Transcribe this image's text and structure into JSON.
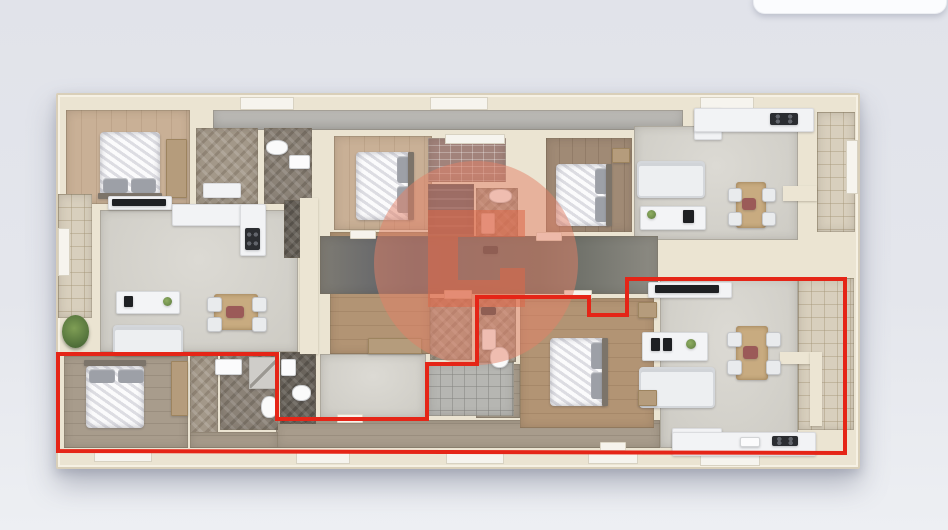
{
  "scene": {
    "canvas": {
      "w": 948,
      "h": 530
    },
    "colors": {
      "background_top": "#e1e3ea",
      "background_bottom": "#edeff3",
      "wall": "#ebe4d2",
      "highlight_red": "#e52517",
      "watermark_circle": "#e48066",
      "watermark_glyph": "#dc6748"
    },
    "overlay_card": {
      "x": 753,
      "y": -12,
      "w": 192,
      "h": 24,
      "radius": 12
    },
    "building": {
      "x": 56,
      "y": 93,
      "w": 800,
      "h": 372
    },
    "rooms": [
      {
        "n": "top-terrace-strip",
        "c": "strip",
        "x": 213,
        "y": 110,
        "w": 470,
        "h": 20
      },
      {
        "n": "bedroom-top-left-floor",
        "c": "wood-light",
        "x": 66,
        "y": 110,
        "w": 124,
        "h": 94
      },
      {
        "n": "closet-top-left-floor",
        "c": "herr-light",
        "x": 196,
        "y": 128,
        "w": 62,
        "h": 76
      },
      {
        "n": "bathroom-top-left-floor",
        "c": "herr-gray",
        "x": 264,
        "y": 128,
        "w": 48,
        "h": 76
      },
      {
        "n": "living-top-left-floor",
        "c": "living",
        "x": 100,
        "y": 210,
        "w": 198,
        "h": 142
      },
      {
        "n": "hall-top-left-floor",
        "c": "herr-dark",
        "x": 284,
        "y": 200,
        "w": 32,
        "h": 58
      },
      {
        "n": "terrace-left-floor",
        "c": "tile-beige",
        "x": 58,
        "y": 194,
        "w": 34,
        "h": 124
      },
      {
        "n": "bedroom-mid-left-floor",
        "c": "wood-med",
        "x": 330,
        "y": 232,
        "w": 100,
        "h": 122
      },
      {
        "n": "bedroom-top-center-floor",
        "c": "wood-light",
        "x": 334,
        "y": 136,
        "w": 98,
        "h": 94
      },
      {
        "n": "brick-patio-floor",
        "c": "brick",
        "x": 428,
        "y": 138,
        "w": 78,
        "h": 44
      },
      {
        "n": "stairwell-floor",
        "c": "stairs",
        "x": 428,
        "y": 184,
        "w": 46,
        "h": 52
      },
      {
        "n": "bathroom-top-center-floor",
        "c": "herr-light",
        "x": 476,
        "y": 188,
        "w": 42,
        "h": 76
      },
      {
        "n": "bedroom-top-right-floor",
        "c": "wood-dark",
        "x": 546,
        "y": 138,
        "w": 86,
        "h": 94
      },
      {
        "n": "living-top-right-floor",
        "c": "living",
        "x": 634,
        "y": 126,
        "w": 164,
        "h": 114
      },
      {
        "n": "terrace-top-right-floor",
        "c": "tile-beige",
        "x": 817,
        "y": 112,
        "w": 38,
        "h": 120
      },
      {
        "n": "corridor-center-floor",
        "c": "corridor",
        "x": 320,
        "y": 236,
        "w": 338,
        "h": 58
      },
      {
        "n": "hall-mid-left-floor",
        "c": "living",
        "x": 320,
        "y": 354,
        "w": 106,
        "h": 64
      },
      {
        "n": "bathroom-notch-floor",
        "c": "herr-light",
        "x": 430,
        "y": 298,
        "w": 42,
        "h": 62
      },
      {
        "n": "bathroom-bottom-center-floor",
        "c": "herr-light",
        "x": 476,
        "y": 298,
        "w": 40,
        "h": 64
      },
      {
        "n": "hall-bottom-center-floor",
        "c": "wood-gray",
        "x": 476,
        "y": 364,
        "w": 44,
        "h": 54
      },
      {
        "n": "corridor-bottom-floor",
        "c": "wood-gray",
        "x": 276,
        "y": 420,
        "w": 384,
        "h": 28
      },
      {
        "n": "tile-patio-bottom-floor",
        "c": "tile-gray",
        "x": 428,
        "y": 362,
        "w": 86,
        "h": 54
      },
      {
        "n": "bedroom-bottom-center-floor",
        "c": "wood-med",
        "x": 520,
        "y": 298,
        "w": 134,
        "h": 130
      },
      {
        "n": "living-bottom-right-floor",
        "c": "living",
        "x": 660,
        "y": 278,
        "w": 138,
        "h": 170
      },
      {
        "n": "terrace-bottom-right-floor",
        "c": "tile-beige",
        "x": 798,
        "y": 278,
        "w": 56,
        "h": 152
      },
      {
        "n": "bedroom-bottom-left-floor",
        "c": "wood-gray",
        "x": 64,
        "y": 356,
        "w": 124,
        "h": 92
      },
      {
        "n": "closet-bottom-left-floor",
        "c": "herr-light",
        "x": 190,
        "y": 356,
        "w": 28,
        "h": 92
      },
      {
        "n": "bathroom-bottom-left-floor",
        "c": "herr-gray",
        "x": 220,
        "y": 354,
        "w": 58,
        "h": 76
      },
      {
        "n": "bathroom-bottom-left2-floor",
        "c": "herr-dark",
        "x": 280,
        "y": 352,
        "w": 36,
        "h": 72
      },
      {
        "n": "hall-bottom-left-floor",
        "c": "wood-gray",
        "x": 190,
        "y": 432,
        "w": 88,
        "h": 16
      }
    ],
    "walls": [
      {
        "n": "balcony-wall-top-right",
        "x": 783,
        "y": 186,
        "w": 34,
        "h": 15
      },
      {
        "n": "balcony-wall-bottom-right",
        "x": 780,
        "y": 352,
        "w": 40,
        "h": 12
      },
      {
        "n": "balcony-wall-bottom-right2",
        "x": 810,
        "y": 352,
        "w": 12,
        "h": 74
      },
      {
        "n": "partition-wall-left",
        "x": 300,
        "y": 198,
        "w": 18,
        "h": 156
      }
    ],
    "windows": [
      {
        "x": 240,
        "y": 97,
        "w": 52,
        "h": 11
      },
      {
        "x": 430,
        "y": 97,
        "w": 56,
        "h": 11
      },
      {
        "x": 700,
        "y": 97,
        "w": 52,
        "h": 11
      },
      {
        "x": 58,
        "y": 228,
        "w": 10,
        "h": 46
      },
      {
        "x": 846,
        "y": 140,
        "w": 10,
        "h": 52
      },
      {
        "x": 94,
        "y": 450,
        "w": 56,
        "h": 10
      },
      {
        "x": 296,
        "y": 452,
        "w": 52,
        "h": 10
      },
      {
        "x": 446,
        "y": 452,
        "w": 56,
        "h": 10
      },
      {
        "x": 588,
        "y": 452,
        "w": 48,
        "h": 10
      },
      {
        "x": 700,
        "y": 454,
        "w": 58,
        "h": 10
      },
      {
        "x": 445,
        "y": 134,
        "w": 58,
        "h": 8
      }
    ],
    "doors": [
      {
        "x": 350,
        "y": 230,
        "w": 24,
        "h": 7
      },
      {
        "x": 536,
        "y": 232,
        "w": 24,
        "h": 7
      },
      {
        "x": 444,
        "y": 290,
        "w": 26,
        "h": 7
      },
      {
        "x": 564,
        "y": 290,
        "w": 26,
        "h": 7
      },
      {
        "x": 337,
        "y": 414,
        "w": 24,
        "h": 7
      },
      {
        "x": 600,
        "y": 442,
        "w": 24,
        "h": 7
      }
    ],
    "furniture": [
      {
        "n": "bed-top-left",
        "c": "bed",
        "x": 100,
        "y": 132,
        "w": 60,
        "h": 64
      },
      {
        "n": "pillow",
        "c": "pillow",
        "x": 103,
        "y": 178,
        "w": 25,
        "h": 15
      },
      {
        "n": "pillow",
        "c": "pillow",
        "x": 131,
        "y": 178,
        "w": 25,
        "h": 15
      },
      {
        "n": "headboard",
        "c": "headboard",
        "x": 98,
        "y": 193,
        "w": 64,
        "h": 6
      },
      {
        "n": "wardrobe-top-left",
        "c": "wardrobe",
        "x": 166,
        "y": 139,
        "w": 19,
        "h": 57
      },
      {
        "n": "desk-top-left",
        "c": "counter",
        "x": 203,
        "y": 183,
        "w": 36,
        "h": 13
      },
      {
        "n": "toilet-top-left",
        "c": "toilet",
        "x": 266,
        "y": 140,
        "w": 20,
        "h": 13
      },
      {
        "n": "sink-top-left",
        "c": "sink",
        "x": 289,
        "y": 155,
        "w": 19,
        "h": 12
      },
      {
        "n": "tv-shelf-top-left",
        "c": "counter",
        "x": 108,
        "y": 196,
        "w": 62,
        "h": 12
      },
      {
        "n": "tv-top-left",
        "c": "tv",
        "x": 112,
        "y": 199,
        "w": 54,
        "h": 7
      },
      {
        "n": "kitchen-counter-top-left",
        "c": "counter",
        "x": 172,
        "y": 204,
        "w": 80,
        "h": 20
      },
      {
        "n": "kitchen-counter2-top-left",
        "c": "counter",
        "x": 240,
        "y": 204,
        "w": 24,
        "h": 50
      },
      {
        "n": "cooktop-top-left",
        "c": "cooktop",
        "x": 245,
        "y": 228,
        "w": 15,
        "h": 22
      },
      {
        "n": "media-unit-top-left",
        "c": "media",
        "x": 116,
        "y": 291,
        "w": 62,
        "h": 21
      },
      {
        "n": "tv-small-top-left",
        "c": "tv",
        "x": 124,
        "y": 296,
        "w": 9,
        "h": 11
      },
      {
        "n": "plant-media-top-left",
        "c": "plantdot",
        "x": 163,
        "y": 297,
        "w": 9,
        "h": 9
      },
      {
        "n": "sofa-top-left",
        "c": "sofa",
        "x": 113,
        "y": 325,
        "w": 66,
        "h": 27
      },
      {
        "n": "dining-table-top-left",
        "c": "table",
        "x": 214,
        "y": 294,
        "w": 44,
        "h": 36
      },
      {
        "n": "chair",
        "c": "chair",
        "x": 207,
        "y": 297,
        "w": 13,
        "h": 13
      },
      {
        "n": "chair",
        "c": "chair",
        "x": 207,
        "y": 317,
        "w": 13,
        "h": 13
      },
      {
        "n": "chair",
        "c": "chair",
        "x": 252,
        "y": 297,
        "w": 13,
        "h": 13
      },
      {
        "n": "chair",
        "c": "chair",
        "x": 252,
        "y": 317,
        "w": 13,
        "h": 13
      },
      {
        "n": "centerpiece",
        "c": "decor",
        "x": 226,
        "y": 306,
        "w": 18,
        "h": 12
      },
      {
        "n": "plant-top-left",
        "c": "plant",
        "x": 62,
        "y": 315,
        "w": 27,
        "h": 33
      },
      {
        "n": "wardrobe-mid-left",
        "c": "wardrobe",
        "x": 368,
        "y": 338,
        "w": 52,
        "h": 14
      },
      {
        "n": "bed-top-center",
        "c": "bed",
        "x": 356,
        "y": 152,
        "w": 56,
        "h": 68
      },
      {
        "n": "pillow",
        "c": "pillow",
        "x": 397,
        "y": 156,
        "w": 14,
        "h": 27
      },
      {
        "n": "pillow",
        "c": "pillow",
        "x": 397,
        "y": 186,
        "w": 14,
        "h": 27
      },
      {
        "n": "headboard",
        "c": "headboard",
        "x": 408,
        "y": 152,
        "w": 6,
        "h": 68
      },
      {
        "n": "toilet-top-center",
        "c": "toilet",
        "x": 489,
        "y": 189,
        "w": 21,
        "h": 12
      },
      {
        "n": "sink-top-center",
        "c": "sink",
        "x": 481,
        "y": 213,
        "w": 12,
        "h": 19
      },
      {
        "n": "shower-head-top-center",
        "c": "decor-dark",
        "x": 483,
        "y": 246,
        "w": 15,
        "h": 8
      },
      {
        "n": "side-table-top-right",
        "c": "wardrobe",
        "x": 612,
        "y": 148,
        "w": 16,
        "h": 13
      },
      {
        "n": "bed-top-right",
        "c": "bed",
        "x": 556,
        "y": 164,
        "w": 54,
        "h": 62
      },
      {
        "n": "pillow",
        "c": "pillow",
        "x": 595,
        "y": 168,
        "w": 13,
        "h": 26
      },
      {
        "n": "pillow",
        "c": "pillow",
        "x": 595,
        "y": 196,
        "w": 13,
        "h": 26
      },
      {
        "n": "headboard",
        "c": "headboard",
        "x": 606,
        "y": 164,
        "w": 6,
        "h": 62
      },
      {
        "n": "sofa-top-right",
        "c": "sofa",
        "x": 637,
        "y": 161,
        "w": 64,
        "h": 33
      },
      {
        "n": "media-unit-top-right",
        "c": "media",
        "x": 640,
        "y": 206,
        "w": 64,
        "h": 22
      },
      {
        "n": "plant-media-top-right",
        "c": "plantdot",
        "x": 647,
        "y": 210,
        "w": 9,
        "h": 9
      },
      {
        "n": "frame-top-right",
        "c": "tv",
        "x": 683,
        "y": 210,
        "w": 11,
        "h": 13
      },
      {
        "n": "dining-table-top-right",
        "c": "table",
        "x": 736,
        "y": 182,
        "w": 30,
        "h": 46
      },
      {
        "n": "chair",
        "c": "chair",
        "x": 728,
        "y": 188,
        "w": 12,
        "h": 12
      },
      {
        "n": "chair",
        "c": "chair",
        "x": 728,
        "y": 212,
        "w": 12,
        "h": 12
      },
      {
        "n": "chair",
        "c": "chair",
        "x": 762,
        "y": 188,
        "w": 12,
        "h": 12
      },
      {
        "n": "chair",
        "c": "chair",
        "x": 762,
        "y": 212,
        "w": 12,
        "h": 12
      },
      {
        "n": "centerpiece",
        "c": "decor",
        "x": 742,
        "y": 198,
        "w": 14,
        "h": 12
      },
      {
        "n": "kitchen-cabinet-top-right",
        "c": "counter",
        "x": 694,
        "y": 108,
        "w": 26,
        "h": 30
      },
      {
        "n": "kitchen-counter-top-right",
        "c": "counter",
        "x": 694,
        "y": 108,
        "w": 118,
        "h": 22
      },
      {
        "n": "cooktop-top-right",
        "c": "cooktop",
        "x": 770,
        "y": 113,
        "w": 28,
        "h": 12
      },
      {
        "n": "tv-shelf-bottom-right",
        "c": "counter",
        "x": 648,
        "y": 282,
        "w": 82,
        "h": 14
      },
      {
        "n": "tv-bottom-right",
        "c": "tv",
        "x": 655,
        "y": 285,
        "w": 64,
        "h": 8
      },
      {
        "n": "media-unit-bottom-right",
        "c": "media",
        "x": 642,
        "y": 332,
        "w": 64,
        "h": 27
      },
      {
        "n": "frame-bottom-right",
        "c": "tv",
        "x": 651,
        "y": 338,
        "w": 9,
        "h": 13
      },
      {
        "n": "frame-bottom-right",
        "c": "tv",
        "x": 663,
        "y": 338,
        "w": 9,
        "h": 13
      },
      {
        "n": "plant-media-bottom-right",
        "c": "plantdot",
        "x": 686,
        "y": 339,
        "w": 10,
        "h": 10
      },
      {
        "n": "sofa-bottom-right",
        "c": "sofa",
        "x": 639,
        "y": 367,
        "w": 72,
        "h": 37
      },
      {
        "n": "dining-table-bottom-right",
        "c": "table",
        "x": 736,
        "y": 326,
        "w": 32,
        "h": 54
      },
      {
        "n": "chair",
        "c": "chair",
        "x": 727,
        "y": 332,
        "w": 13,
        "h": 13
      },
      {
        "n": "chair",
        "c": "chair",
        "x": 727,
        "y": 360,
        "w": 13,
        "h": 13
      },
      {
        "n": "chair",
        "c": "chair",
        "x": 766,
        "y": 332,
        "w": 13,
        "h": 13
      },
      {
        "n": "chair",
        "c": "chair",
        "x": 766,
        "y": 360,
        "w": 13,
        "h": 13
      },
      {
        "n": "centerpiece",
        "c": "decor",
        "x": 743,
        "y": 346,
        "w": 15,
        "h": 13
      },
      {
        "n": "kitchen-cabinet-bottom-right",
        "c": "counter",
        "x": 672,
        "y": 428,
        "w": 48,
        "h": 18
      },
      {
        "n": "kitchen-counter-bottom-right",
        "c": "counter",
        "x": 672,
        "y": 432,
        "w": 142,
        "h": 22
      },
      {
        "n": "cooktop-bottom-right",
        "c": "cooktop",
        "x": 772,
        "y": 436,
        "w": 26,
        "h": 10
      },
      {
        "n": "kitchen-sink-bottom-right",
        "c": "sink",
        "x": 740,
        "y": 437,
        "w": 18,
        "h": 8
      },
      {
        "n": "bed-bottom-center",
        "c": "bed",
        "x": 550,
        "y": 338,
        "w": 56,
        "h": 68
      },
      {
        "n": "pillow",
        "c": "pillow",
        "x": 591,
        "y": 342,
        "w": 14,
        "h": 27
      },
      {
        "n": "pillow",
        "c": "pillow",
        "x": 591,
        "y": 372,
        "w": 14,
        "h": 27
      },
      {
        "n": "headboard",
        "c": "headboard",
        "x": 602,
        "y": 338,
        "w": 6,
        "h": 68
      },
      {
        "n": "side-table-bottom-center",
        "c": "wardrobe",
        "x": 638,
        "y": 302,
        "w": 17,
        "h": 14
      },
      {
        "n": "side-table-bottom-center",
        "c": "wardrobe",
        "x": 638,
        "y": 390,
        "w": 17,
        "h": 14
      },
      {
        "n": "shower-head-bottom-center",
        "c": "decor-dark",
        "x": 481,
        "y": 307,
        "w": 15,
        "h": 8
      },
      {
        "n": "sink-bottom-center",
        "c": "sink",
        "x": 482,
        "y": 329,
        "w": 12,
        "h": 19
      },
      {
        "n": "toilet-bottom-center",
        "c": "toilet",
        "x": 490,
        "y": 347,
        "w": 17,
        "h": 19
      },
      {
        "n": "headboard",
        "c": "headboard",
        "x": 84,
        "y": 360,
        "w": 62,
        "h": 6
      },
      {
        "n": "bed-bottom-left",
        "c": "bed",
        "x": 86,
        "y": 366,
        "w": 58,
        "h": 62
      },
      {
        "n": "pillow",
        "c": "pillow",
        "x": 89,
        "y": 369,
        "w": 26,
        "h": 14
      },
      {
        "n": "pillow",
        "c": "pillow",
        "x": 118,
        "y": 369,
        "w": 26,
        "h": 14
      },
      {
        "n": "wardrobe-bottom-left",
        "c": "wardrobe",
        "x": 171,
        "y": 361,
        "w": 15,
        "h": 53
      },
      {
        "n": "sink-bottom-left",
        "c": "sink",
        "x": 215,
        "y": 359,
        "w": 25,
        "h": 14
      },
      {
        "n": "shower-bottom-left",
        "c": "shower",
        "x": 249,
        "y": 357,
        "w": 28,
        "h": 30
      },
      {
        "n": "toilet-bottom-left",
        "c": "toilet",
        "x": 261,
        "y": 396,
        "w": 15,
        "h": 20
      },
      {
        "n": "sink-bottom-left2",
        "c": "sink",
        "x": 281,
        "y": 359,
        "w": 13,
        "h": 15
      },
      {
        "n": "toilet-bottom-left2",
        "c": "toilet",
        "x": 292,
        "y": 385,
        "w": 17,
        "h": 14
      }
    ],
    "watermark": {
      "cx": 476,
      "cy": 263,
      "r": 102,
      "circle_opacity": 0.5,
      "glyph_opacity": 0.55,
      "glyph_path": "M428,210 H525 V237 H458 V280 H500 V268 H525 V307 H428 Z"
    },
    "highlight_outline": {
      "points": "58,451 58,354 277,354 277,419 427,419 427,364 477,364 477,297 589,297 589,315 627,315 627,279 845,279 845,453",
      "width": 4
    }
  }
}
